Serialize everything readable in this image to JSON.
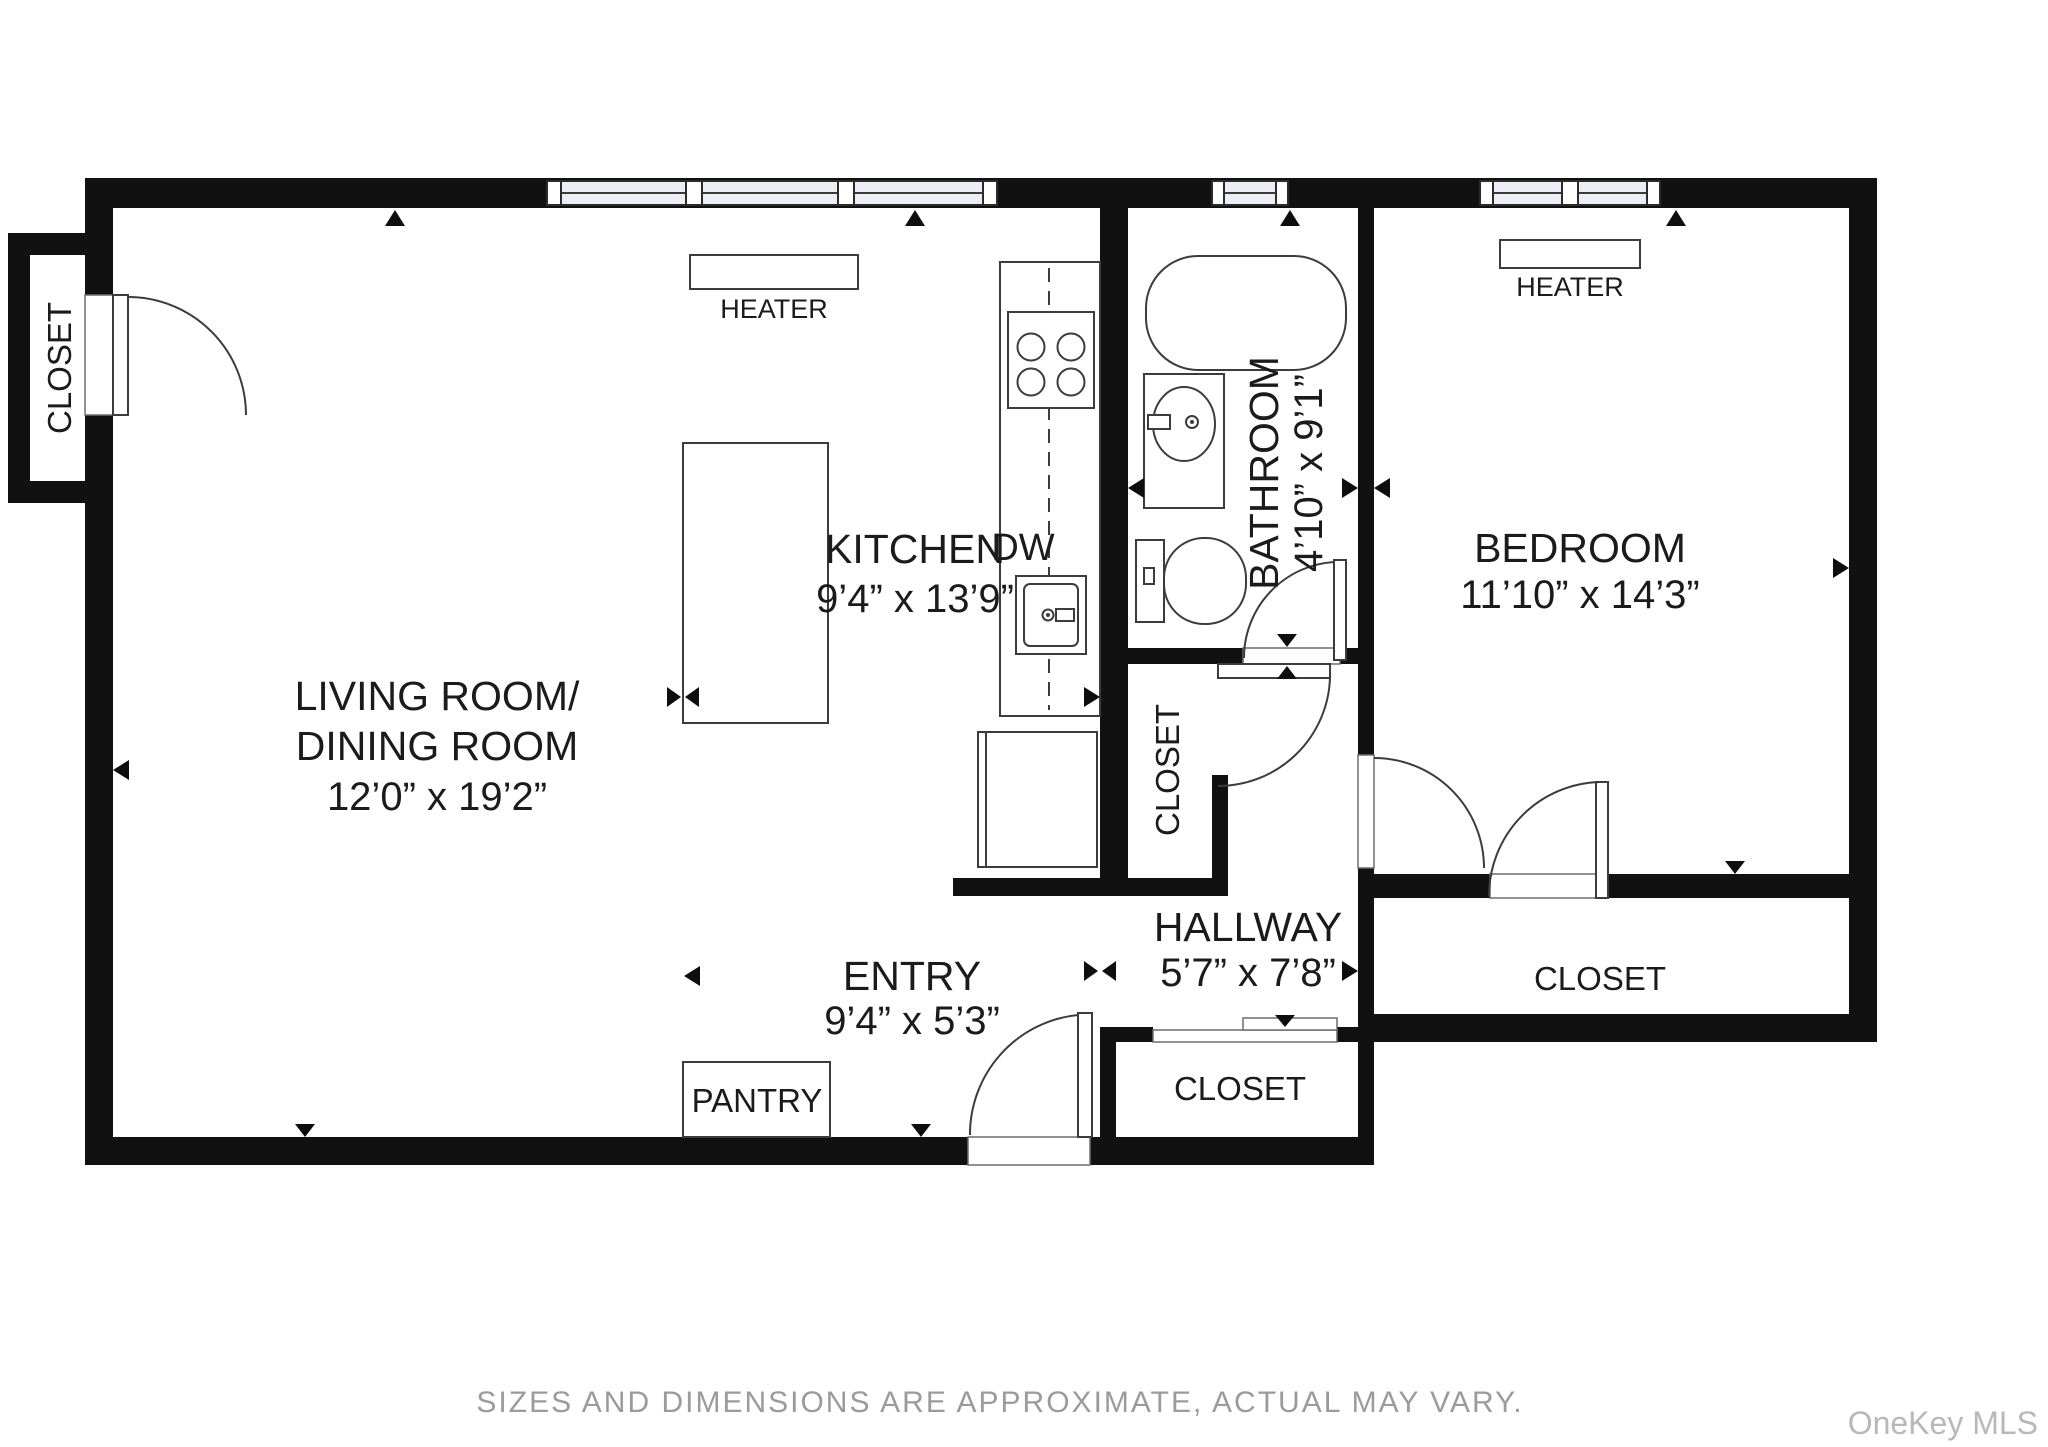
{
  "plan": {
    "rooms": {
      "living": {
        "line1": "LIVING ROOM/",
        "line2": "DINING ROOM",
        "dims": "12’0” x 19’2”"
      },
      "kitchen": {
        "name": "KITCHEN",
        "dims": "9’4” x 13’9”"
      },
      "bathroom": {
        "name": "BATHROOM",
        "dims": "4’10” x 9’1”"
      },
      "bedroom": {
        "name": "BEDROOM",
        "dims": "11’10” x 14’3”"
      },
      "hallway": {
        "name": "HALLWAY",
        "dims": "5’7” x 7’8”"
      },
      "entry": {
        "name": "ENTRY",
        "dims": "9’4” x 5’3”"
      }
    },
    "labels": {
      "closet_top_left": "CLOSET",
      "closet_middle": "CLOSET",
      "closet_bottom": "CLOSET",
      "closet_bedroom": "CLOSET",
      "pantry": "PANTRY",
      "heater_living": "HEATER",
      "heater_bedroom": "HEATER",
      "dishwasher": "DW"
    }
  },
  "footer": {
    "caption": "SIZES AND DIMENSIONS ARE APPROXIMATE, ACTUAL MAY VARY.",
    "watermark": "OneKey MLS"
  },
  "colors": {
    "wall": "#111111",
    "window_fill": "#eceef6",
    "caption_text": "#9b9b9b",
    "watermark_text": "#b8b8b8",
    "background": "#ffffff"
  }
}
